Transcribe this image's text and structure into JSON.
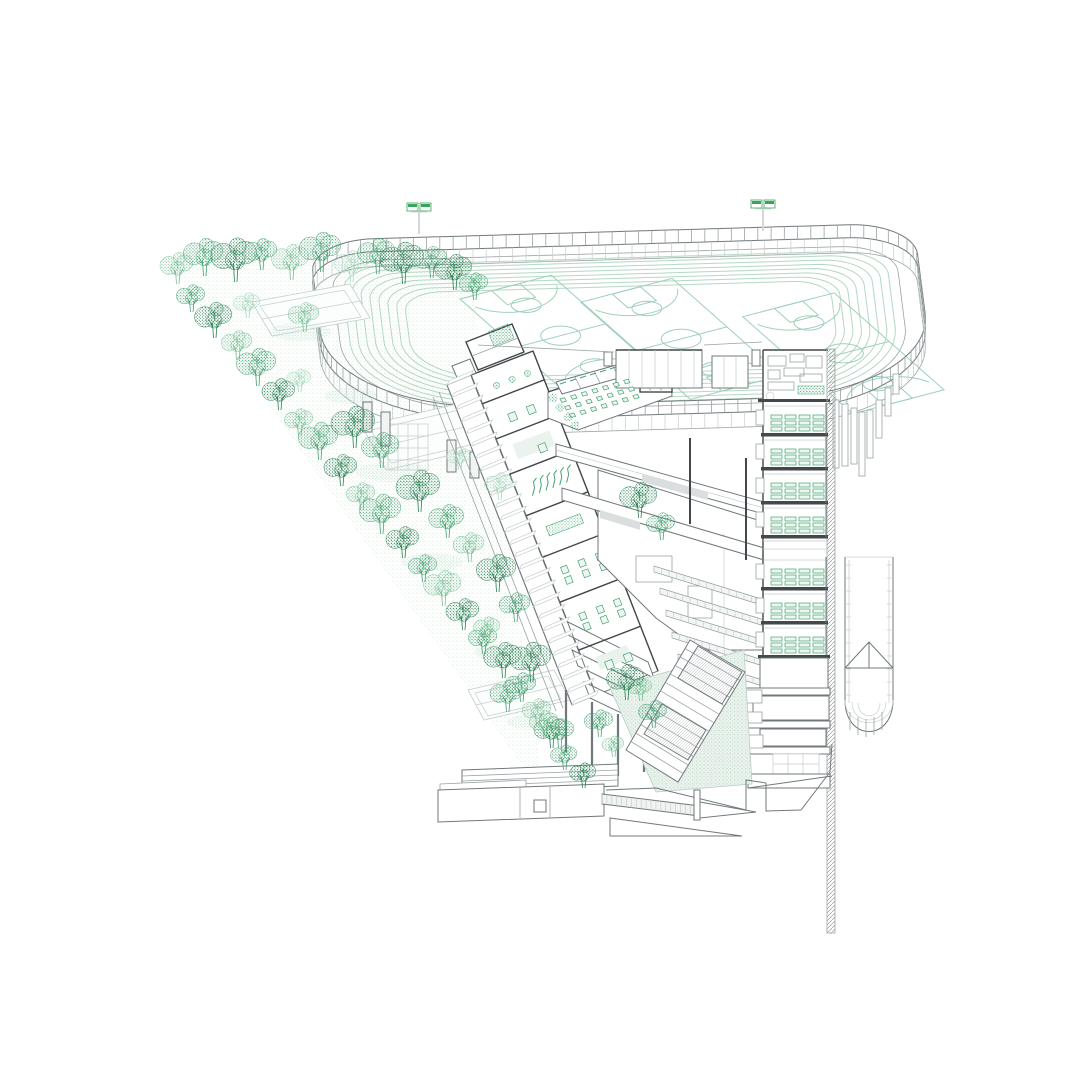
{
  "palette": {
    "ink_dark": "#41474a",
    "ink": "#70787b",
    "ink_light": "#9aa2a4",
    "ink_faint": "#c7cdcd",
    "panel_gray": "#dadedf",
    "track_green": "#b5d8c4",
    "court_green": "#9fd0b8",
    "tree_dark": "#2a8153",
    "tree_mid": "#46a372",
    "tree_light": "#79c096",
    "tree_pale": "#a8d8bd",
    "mint_fill": "#e9f2ec",
    "mint_dot": "#bdd8c7",
    "lamp_green": "#3aa45c",
    "slab_dark": "#43494b",
    "background": "#ffffff"
  },
  "scene": {
    "track": {
      "cx": 622,
      "cy": 330,
      "rot_deg": -3.5,
      "y_scale": 0.48,
      "half_w": 283,
      "half_h": 160,
      "corner_top": 55,
      "corner_bottom": 150,
      "lanes": 8,
      "lane_gap": 8.5,
      "lane_inset": 10,
      "fence_offset": 20,
      "fence_height": 13,
      "fascia_depth": 15,
      "samples": 260,
      "court_half_w": 52,
      "court_half_l": 115,
      "courts": [
        {
          "cx": -62,
          "cy": 8,
          "rot_deg": -25
        },
        {
          "cx": 58,
          "cy": 22,
          "rot_deg": -25
        },
        {
          "cx": 218,
          "cy": 62,
          "rot_deg": -25
        }
      ],
      "floodlights": [
        {
          "x": 419,
          "y": 234
        },
        {
          "x": 763,
          "y": 231
        }
      ]
    },
    "park": {
      "boundary": [
        [
          168,
          262
        ],
        [
          468,
          262
        ],
        [
          545,
          798
        ]
      ],
      "courts": [
        {
          "quad": [
            [
              252,
              302
            ],
            [
              350,
              284
            ],
            [
              370,
              318
            ],
            [
              272,
              336
            ]
          ],
          "inset": [
            [
              260,
              306
            ],
            [
              344,
              290
            ],
            [
              361,
              317
            ],
            [
              277,
              331
            ]
          ],
          "mid": [
            [
              262,
              319
            ],
            [
              360,
              301
            ]
          ]
        },
        {
          "quad": [
            [
              362,
              426
            ],
            [
              466,
              402
            ],
            [
              490,
              446
            ],
            [
              386,
              470
            ]
          ],
          "inset": [
            [
              371,
              430
            ],
            [
              459,
              410
            ],
            [
              479,
              443
            ],
            [
              391,
              463
            ]
          ],
          "mid": [
            [
              374,
              448
            ],
            [
              478,
              424
            ]
          ]
        },
        {
          "quad": [
            [
              468,
              690
            ],
            [
              554,
              670
            ],
            [
              570,
              700
            ],
            [
              484,
              720
            ]
          ],
          "inset": [
            [
              475,
              693
            ],
            [
              548,
              676
            ],
            [
              561,
              699
            ],
            [
              488,
              716
            ]
          ],
          "mid": [
            [
              476,
              705
            ],
            [
              562,
              685
            ]
          ]
        }
      ],
      "mounds": [
        [
          300,
          332,
          62,
          18
        ],
        [
          392,
          472,
          72,
          20
        ],
        [
          432,
          562,
          62,
          18
        ],
        [
          502,
          652,
          56,
          16
        ],
        [
          532,
          722,
          50,
          15
        ],
        [
          600,
          502,
          50,
          16
        ],
        [
          644,
          562,
          44,
          14
        ],
        [
          352,
          396,
          54,
          16
        ]
      ],
      "facade": {
        "x": 388,
        "y": 424,
        "w": 40,
        "h": 46,
        "cols": 3,
        "rows": 3
      },
      "columns": [
        [
          363,
          402,
          9,
          30
        ],
        [
          381,
          412,
          9,
          34
        ],
        [
          447,
          440,
          9,
          32
        ],
        [
          470,
          452,
          9,
          26
        ]
      ]
    },
    "trees": [
      [
        178,
        284,
        30,
        "l"
      ],
      [
        205,
        276,
        36,
        "m"
      ],
      [
        236,
        282,
        42,
        "d"
      ],
      [
        262,
        270,
        30,
        "m"
      ],
      [
        292,
        280,
        34,
        "l"
      ],
      [
        322,
        272,
        38,
        "m"
      ],
      [
        352,
        282,
        30,
        "p"
      ],
      [
        378,
        274,
        34,
        "m"
      ],
      [
        404,
        284,
        40,
        "d"
      ],
      [
        432,
        278,
        30,
        "m"
      ],
      [
        455,
        290,
        34,
        "d"
      ],
      [
        475,
        300,
        26,
        "m"
      ],
      [
        192,
        312,
        26,
        "m"
      ],
      [
        215,
        338,
        34,
        "d"
      ],
      [
        238,
        360,
        28,
        "l"
      ],
      [
        258,
        386,
        36,
        "m"
      ],
      [
        280,
        410,
        30,
        "d"
      ],
      [
        300,
        436,
        26,
        "l"
      ],
      [
        320,
        460,
        36,
        "m"
      ],
      [
        342,
        486,
        30,
        "d"
      ],
      [
        362,
        510,
        26,
        "l"
      ],
      [
        382,
        534,
        38,
        "m"
      ],
      [
        404,
        558,
        30,
        "d"
      ],
      [
        424,
        582,
        26,
        "m"
      ],
      [
        444,
        606,
        34,
        "l"
      ],
      [
        464,
        630,
        30,
        "d"
      ],
      [
        484,
        654,
        26,
        "m"
      ],
      [
        504,
        678,
        34,
        "d"
      ],
      [
        522,
        702,
        28,
        "m"
      ],
      [
        538,
        726,
        26,
        "l"
      ],
      [
        552,
        748,
        30,
        "d"
      ],
      [
        565,
        770,
        24,
        "m"
      ],
      [
        248,
        318,
        24,
        "p"
      ],
      [
        305,
        332,
        28,
        "l"
      ],
      [
        355,
        448,
        40,
        "d"
      ],
      [
        382,
        468,
        34,
        "m"
      ],
      [
        300,
        392,
        22,
        "p"
      ],
      [
        420,
        512,
        40,
        "d"
      ],
      [
        448,
        538,
        32,
        "m"
      ],
      [
        470,
        562,
        28,
        "l"
      ],
      [
        498,
        592,
        36,
        "d"
      ],
      [
        516,
        622,
        28,
        "m"
      ],
      [
        488,
        642,
        24,
        "l"
      ],
      [
        532,
        682,
        38,
        "d"
      ],
      [
        508,
        712,
        30,
        "m"
      ],
      [
        545,
        738,
        26,
        "l"
      ],
      [
        500,
        500,
        26,
        "p"
      ],
      [
        460,
        470,
        22,
        "p"
      ],
      [
        640,
        518,
        34,
        "d"
      ],
      [
        662,
        540,
        26,
        "m"
      ],
      [
        600,
        737,
        26,
        "m"
      ],
      [
        641,
        701,
        22,
        "l"
      ],
      [
        627,
        700,
        34,
        "d"
      ],
      [
        654,
        728,
        26,
        "m"
      ],
      [
        560,
        748,
        28,
        "m"
      ],
      [
        614,
        757,
        20,
        "l"
      ],
      [
        584,
        788,
        24,
        "d"
      ]
    ],
    "wing": {
      "rail_left": [
        447,
        385
      ],
      "rail_right": [
        471,
        375
      ],
      "cut_left": [
        471,
        375
      ],
      "cut_right": [
        533,
        351
      ],
      "axis": [
        125,
        320
      ],
      "steps": 26,
      "walls": [
        0.09,
        0.2,
        0.31,
        0.44,
        0.57,
        0.71,
        0.86
      ],
      "rooms": [
        "plant",
        "tables",
        "rug",
        "bamboo",
        "screen",
        "desks",
        "desks",
        "board"
      ]
    },
    "terrace": {
      "origin": [
        560,
        399
      ],
      "rows": 3,
      "cols": 7,
      "col_step": [
        10.6,
        -3.1
      ],
      "row_step": [
        4.6,
        7.6
      ],
      "shrubs": [
        [
          553,
          398
        ],
        [
          560,
          408
        ],
        [
          568,
          417
        ],
        [
          575,
          425
        ]
      ]
    },
    "steps_bands": {
      "n": 5,
      "x0": 654,
      "y0": 566,
      "dx": 6,
      "dy": 22,
      "len": 150,
      "drop": 46,
      "h": 6
    },
    "tower": {
      "x": 763,
      "w": 65,
      "top": 350,
      "floor_ys": [
        403,
        437,
        471,
        505,
        557,
        591,
        625
      ],
      "floor_h": 32,
      "clusters": [
        771,
        785,
        799,
        813
      ],
      "desk_rows": 3
    },
    "fins": {
      "x": [
        836,
        845,
        854,
        862,
        870,
        879,
        888,
        896
      ],
      "top": [
        400,
        404,
        408,
        412,
        410,
        400,
        388,
        374
      ],
      "len": [
        68,
        62,
        56,
        64,
        48,
        38,
        28,
        20
      ]
    },
    "cylinder": {
      "x1": 845,
      "x2": 893,
      "y1": 557,
      "y2": 742,
      "rung_step": 13
    },
    "grand_stair": {
      "quad": [
        [
          690,
          640
        ],
        [
          745,
          672
        ],
        [
          678,
          782
        ],
        [
          626,
          750
        ]
      ],
      "treads": 13
    },
    "ramp": {
      "a": [
        602,
        794
      ],
      "b": [
        700,
        806
      ],
      "a2": [
        602,
        804
      ],
      "b2": [
        700,
        816
      ],
      "ticks": 20
    }
  }
}
